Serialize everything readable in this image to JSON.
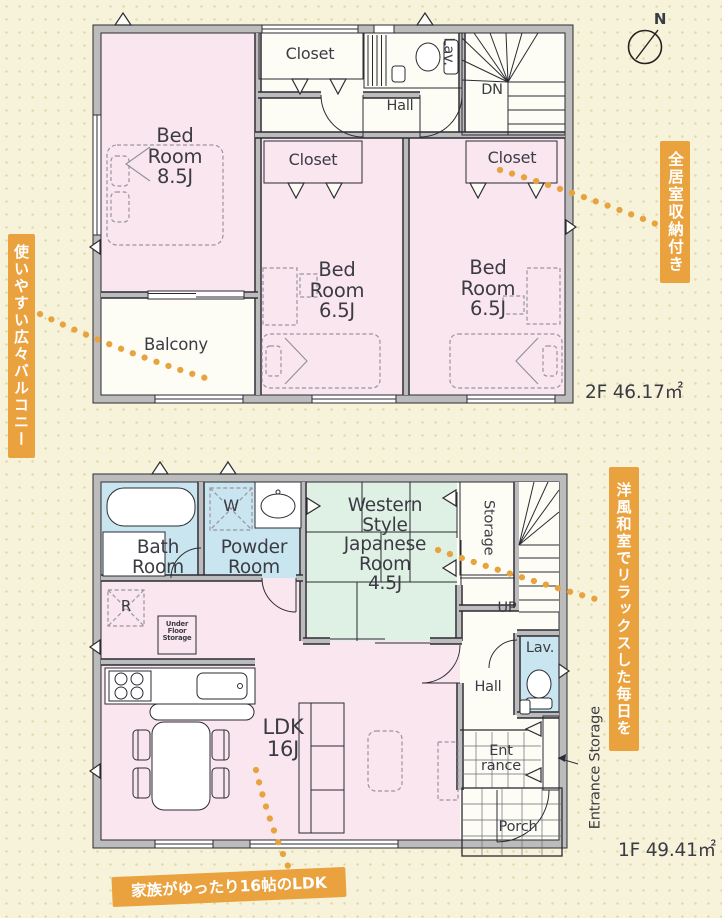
{
  "compass": {
    "north": "N"
  },
  "annotations": {
    "balcony_note": "使いやすい広々バルコニー",
    "storage_note": "全居室収納付き",
    "japanese_note": "洋風和室でリラックスした毎日を",
    "ldk_note": "家族がゆったり16帖のLDK"
  },
  "floor2": {
    "area": "2F 46.17㎡",
    "bedroom1": {
      "l1": "Bed",
      "l2": "Room",
      "l3": "8.5J"
    },
    "bedroom2": {
      "l1": "Bed",
      "l2": "Room",
      "l3": "6.5J"
    },
    "bedroom3": {
      "l1": "Bed",
      "l2": "Room",
      "l3": "6.5J"
    },
    "closet1": "Closet",
    "closet2": "Closet",
    "closet3": "Closet",
    "lav": "Lav.",
    "stairs": "DN",
    "hall": "Hall",
    "balcony": "Balcony"
  },
  "floor1": {
    "area": "1F 49.41㎡",
    "bath": {
      "l1": "Bath",
      "l2": "Room"
    },
    "powder": {
      "l1": "Powder",
      "l2": "Room"
    },
    "washer": "W",
    "fridge": "R",
    "japanese": {
      "l1": "Western",
      "l2": "Style",
      "l3": "Japanese",
      "l4": "Room",
      "l5": "4.5J"
    },
    "storage": "Storage",
    "stairs": "UP",
    "lav": "Lav.",
    "hall": "Hall",
    "under_floor": {
      "l1": "Under",
      "l2": "Floor",
      "l3": "Storage"
    },
    "ldk": {
      "l1": "LDK",
      "l2": "16J"
    },
    "entrance": {
      "l1": "Ent",
      "l2": "rance"
    },
    "porch": "Porch",
    "entrance_storage": "Entrance Storage"
  },
  "colors": {
    "accent_orange": "#eaa23f",
    "room_pink": "#f9e6ef",
    "room_blue": "#c9e5ef",
    "room_yellow": "#eff0c6",
    "room_green": "#dff0e4",
    "wall_gray": "#bcbcbc",
    "background": "#f7f3da"
  }
}
